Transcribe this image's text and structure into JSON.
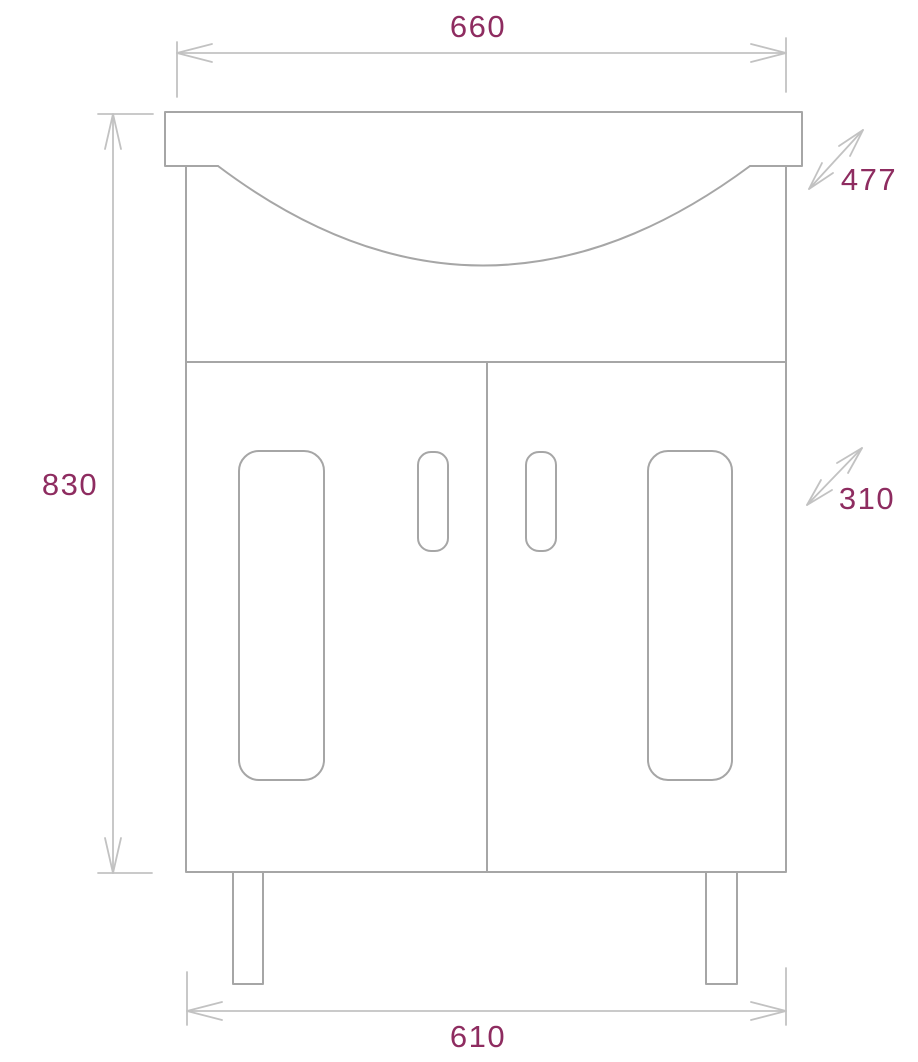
{
  "drawing": {
    "subject": "bathroom-vanity-with-washbasin-front-elevation",
    "unit_hint": "",
    "dimensions": {
      "width_top": "660",
      "depth_basin": "477",
      "height": "830",
      "depth_cabinet": "310",
      "width_bottom": "610"
    },
    "colors": {
      "outline": "#a6a6a6",
      "dimension_lines": "#c2c2c2",
      "dimension_text": "#8e2c60",
      "background": "#ffffff"
    }
  }
}
